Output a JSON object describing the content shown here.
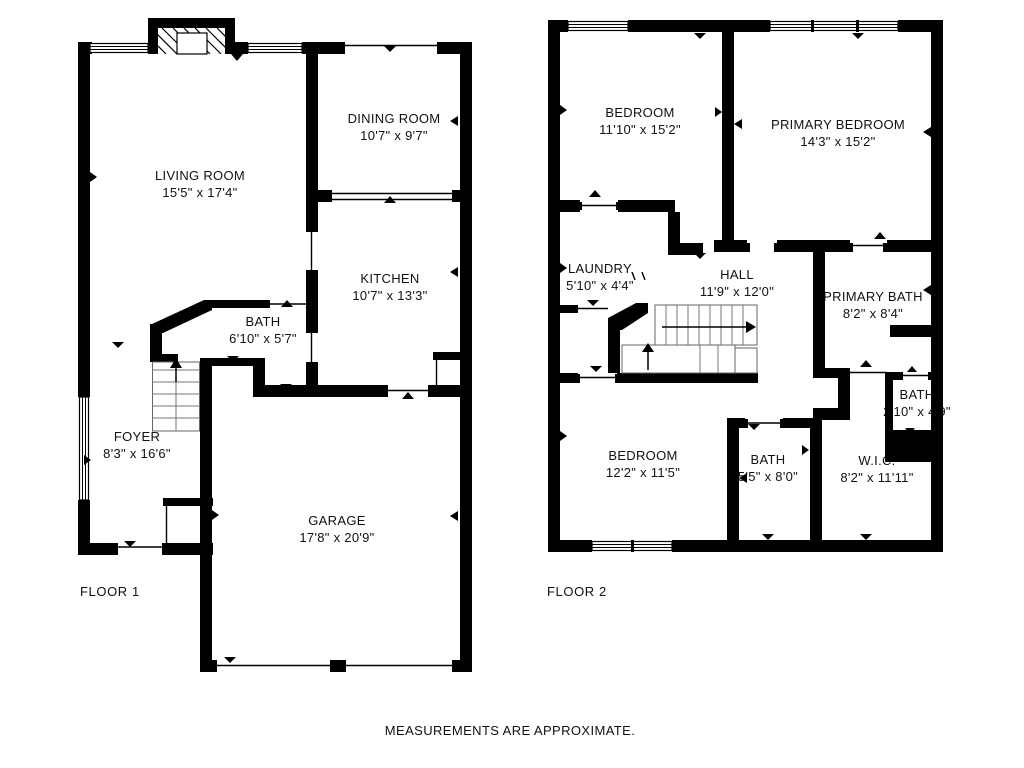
{
  "footer_note": "MEASUREMENTS ARE APPROXIMATE.",
  "colors": {
    "wall": "#000000",
    "background": "#ffffff",
    "text": "#111111"
  },
  "floors": [
    {
      "label": "FLOOR 1",
      "rooms": [
        {
          "name": "LIVING ROOM",
          "dims": "15'5\" x 17'4\""
        },
        {
          "name": "DINING ROOM",
          "dims": "10'7\" x 9'7\""
        },
        {
          "name": "KITCHEN",
          "dims": "10'7\" x 13'3\""
        },
        {
          "name": "BATH",
          "dims": "6'10\" x 5'7\""
        },
        {
          "name": "FOYER",
          "dims": "8'3\" x 16'6\""
        },
        {
          "name": "GARAGE",
          "dims": "17'8\" x 20'9\""
        }
      ]
    },
    {
      "label": "FLOOR 2",
      "rooms": [
        {
          "name": "BEDROOM",
          "dims": "11'10\" x 15'2\""
        },
        {
          "name": "PRIMARY BEDROOM",
          "dims": "14'3\" x 15'2\""
        },
        {
          "name": "LAUNDRY",
          "dims": "5'10\" x 4'4\""
        },
        {
          "name": "HALL",
          "dims": "11'9\" x 12'0\""
        },
        {
          "name": "PRIMARY BATH",
          "dims": "8'2\" x 8'4\""
        },
        {
          "name": "BATH",
          "dims": "2'10\" x 4'9\""
        },
        {
          "name": "BEDROOM",
          "dims": "12'2\" x 11'5\""
        },
        {
          "name": "BATH",
          "dims": "5'5\" x 8'0\""
        },
        {
          "name": "W.I.C.",
          "dims": "8'2\" x 11'11\""
        }
      ]
    }
  ]
}
